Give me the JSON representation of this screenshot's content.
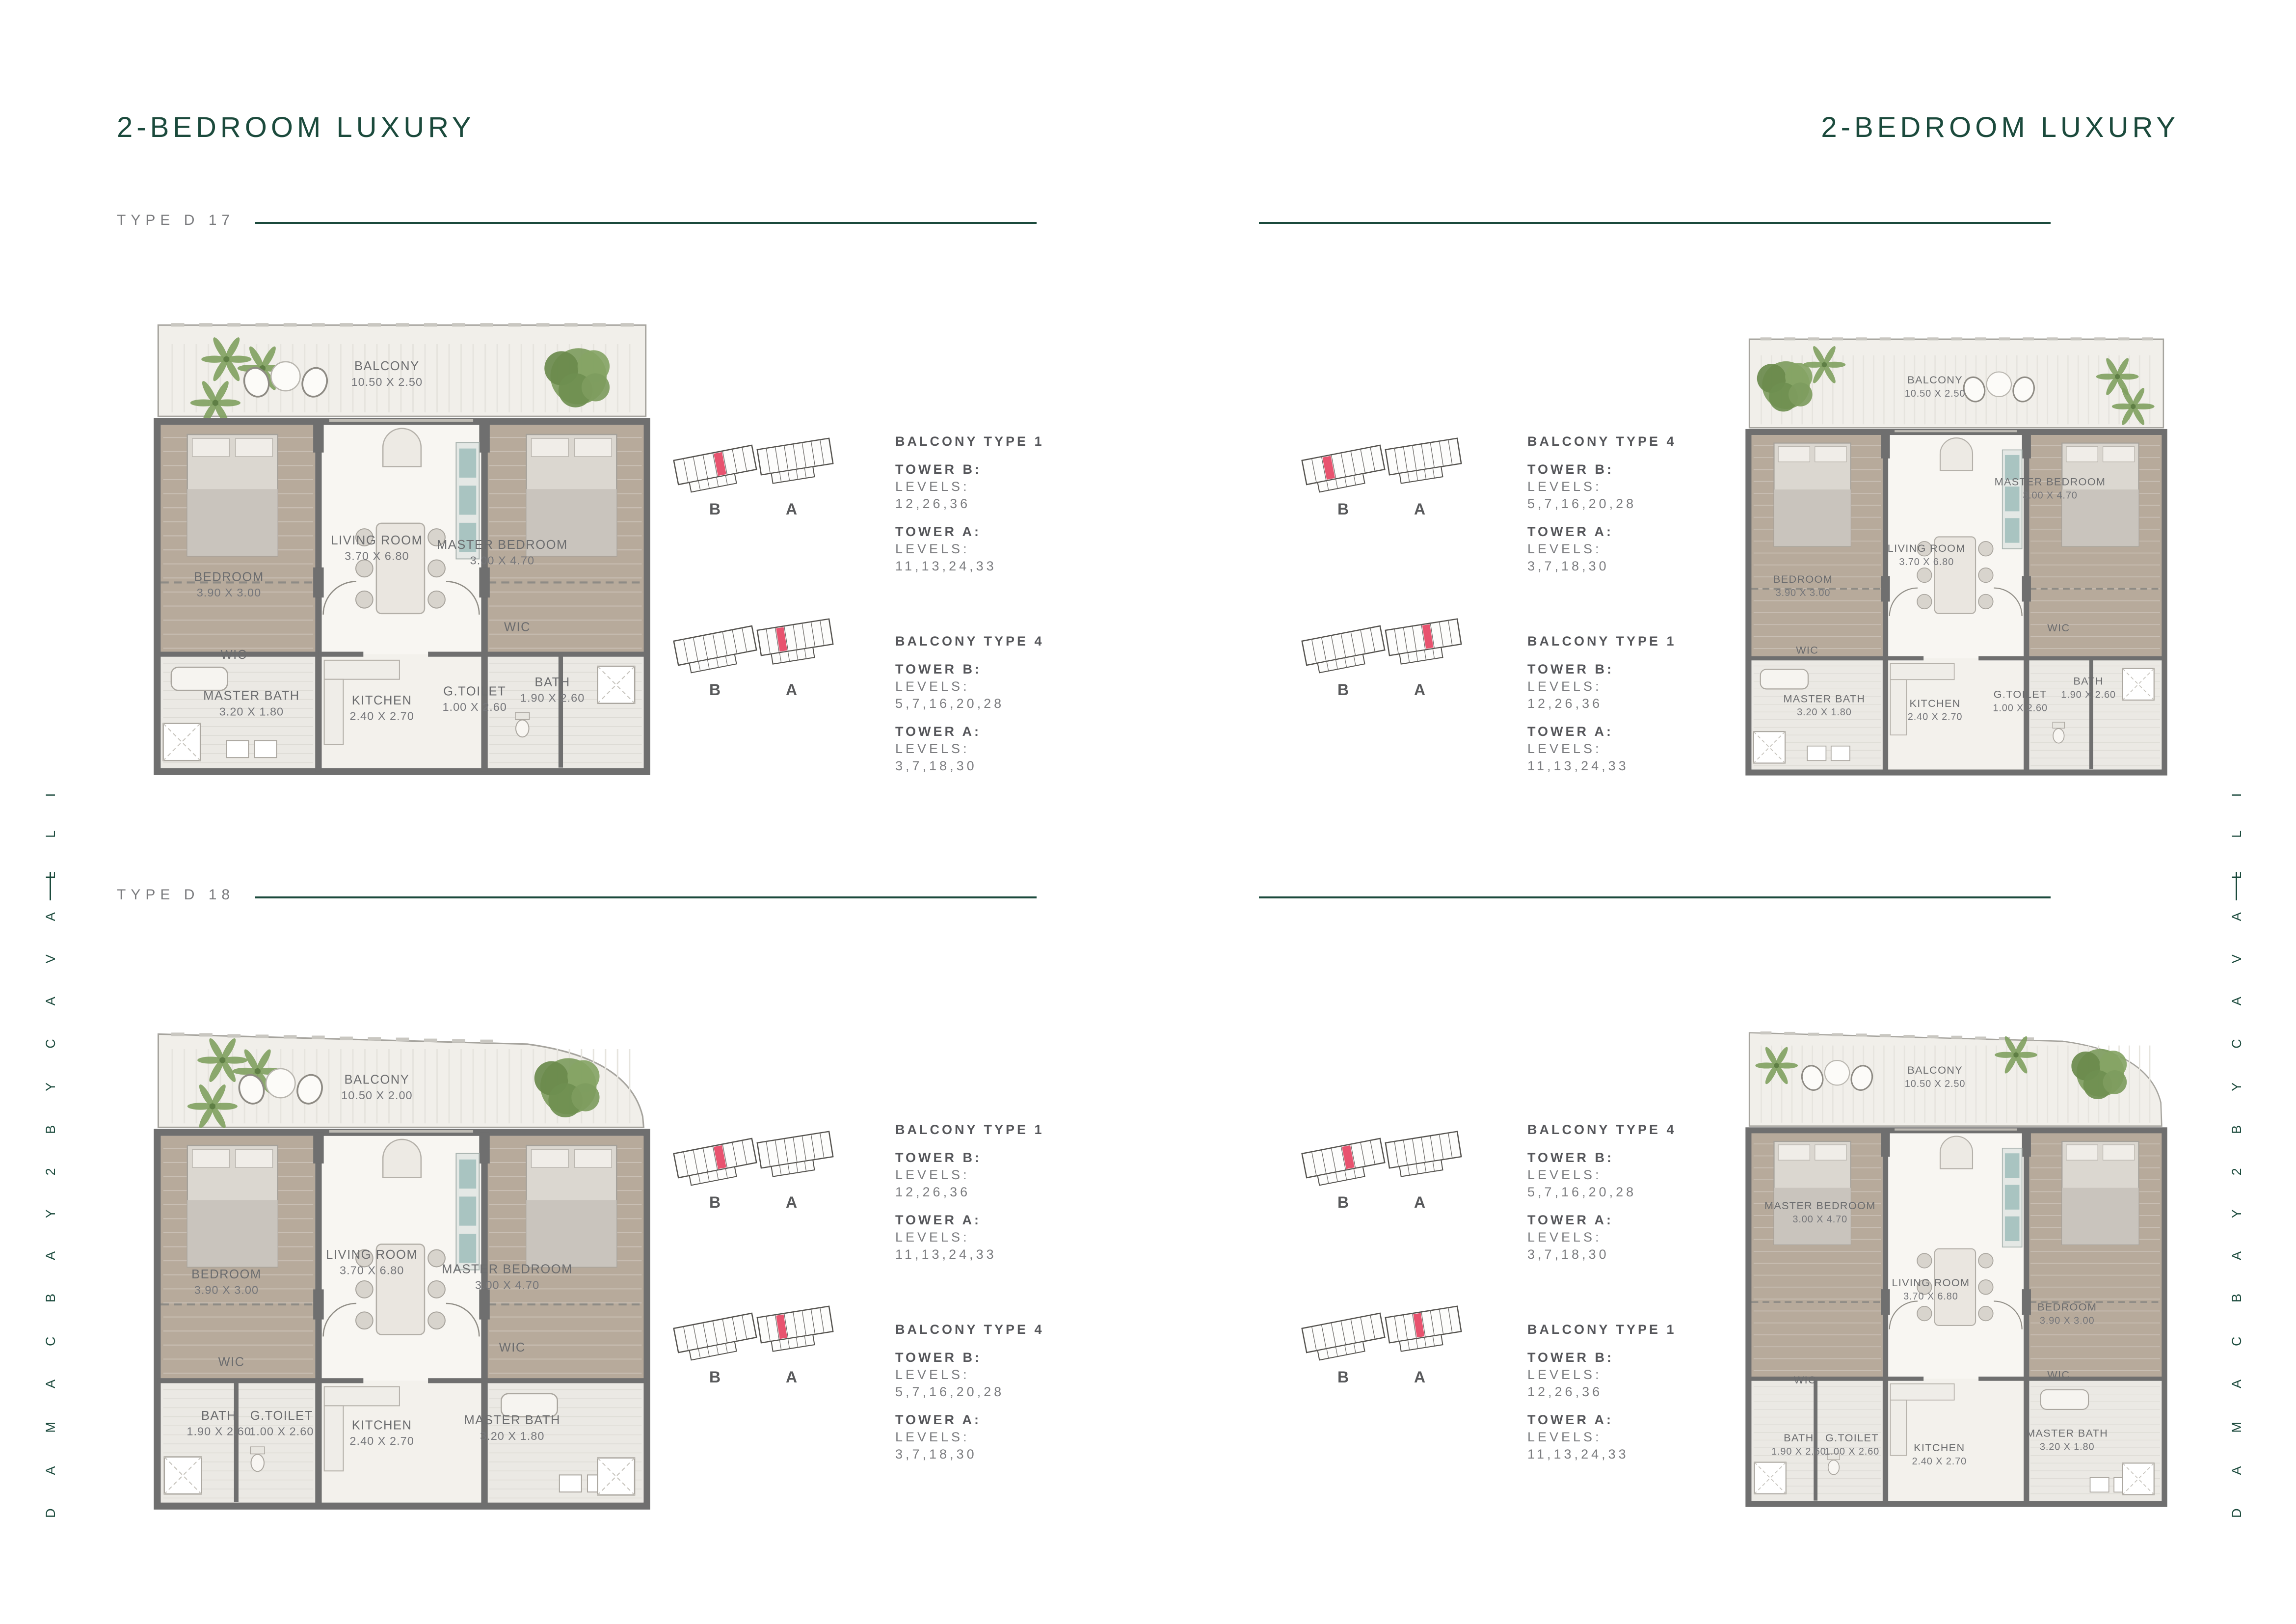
{
  "page": {
    "headers": {
      "left": "2-BEDROOM LUXURY",
      "right": "2-BEDROOM LUXURY"
    },
    "side_text": {
      "left": "D A M A C   B A Y 2   B Y   C A V A L L I",
      "right": "D A M A C   B A Y 2   B Y   C A V A L L I"
    },
    "colors": {
      "brand_green": "#1B4A3C",
      "type_gray": "#797A7D",
      "info_dark": "#55565A",
      "info_light": "#7B7C7F",
      "highlight_red": "#E8536F",
      "wall_gray": "#6F6F6F",
      "floor_tan": "#B7AA9B",
      "floor_tile": "#EBE9E4",
      "balcony": "#F1EFEA"
    }
  },
  "key_plan_labels": {
    "tower_b": "B",
    "tower_a": "A"
  },
  "quadrants": [
    {
      "id": "d17",
      "type_label": "TYPE D 17",
      "plan": {
        "balcony_curve": "none",
        "bath_split": "right",
        "rooms": [
          {
            "name": "BALCONY",
            "dims": "10.50 X 2.50",
            "x": 47,
            "y": 11
          },
          {
            "name": "BEDROOM",
            "dims": "3.90 X 3.00",
            "x": 15.5,
            "y": 57
          },
          {
            "name": "LIVING ROOM",
            "dims": "3.70 X 6.80",
            "x": 45,
            "y": 49
          },
          {
            "name": "MASTER BEDROOM",
            "dims": "3.00 X 4.70",
            "x": 70,
            "y": 50
          },
          {
            "name": "WIC",
            "dims": "",
            "x": 16.5,
            "y": 74
          },
          {
            "name": "WIC",
            "dims": "",
            "x": 73,
            "y": 68
          },
          {
            "name": "MASTER BATH",
            "dims": "3.20 X 1.80",
            "x": 20,
            "y": 83
          },
          {
            "name": "KITCHEN",
            "dims": "2.40 X 2.70",
            "x": 46,
            "y": 84
          },
          {
            "name": "G.TOILET",
            "dims": "1.00 X 2.60",
            "x": 64.5,
            "y": 82
          },
          {
            "name": "BATH",
            "dims": "1.90 X 2.60",
            "x": 80,
            "y": 80
          }
        ]
      },
      "key_plans": [
        {
          "highlight_tower": "B",
          "highlight_cell": 4
        },
        {
          "highlight_tower": "A",
          "highlight_cell": 2
        }
      ],
      "info_groups": [
        {
          "title": "BALCONY TYPE 1",
          "entries": [
            {
              "tower": "TOWER B:",
              "levels_label": "LEVELS:",
              "levels": "12,26,36"
            },
            {
              "tower": "TOWER A:",
              "levels_label": "LEVELS:",
              "levels": "11,13,24,33"
            }
          ]
        },
        {
          "title": "BALCONY TYPE 4",
          "entries": [
            {
              "tower": "TOWER B:",
              "levels_label": "LEVELS:",
              "levels": "5,7,16,20,28"
            },
            {
              "tower": "TOWER A:",
              "levels_label": "LEVELS:",
              "levels": "3,7,18,30"
            }
          ]
        }
      ]
    },
    {
      "id": "d19",
      "type_label": "TYPE D 19",
      "plan": {
        "balcony_curve": "none",
        "bath_split": "right",
        "rooms": [
          {
            "name": "BALCONY",
            "dims": "10.50 X 2.50",
            "x": 45,
            "y": 11
          },
          {
            "name": "BEDROOM",
            "dims": "3.90 X 3.00",
            "x": 14,
            "y": 56
          },
          {
            "name": "LIVING ROOM",
            "dims": "3.70 X 6.80",
            "x": 43,
            "y": 49
          },
          {
            "name": "MASTER BEDROOM",
            "dims": "3.00 X 4.70",
            "x": 72,
            "y": 34
          },
          {
            "name": "WIC",
            "dims": "",
            "x": 15,
            "y": 72
          },
          {
            "name": "WIC",
            "dims": "",
            "x": 74,
            "y": 67
          },
          {
            "name": "MASTER BATH",
            "dims": "3.20 X 1.80",
            "x": 19,
            "y": 83
          },
          {
            "name": "KITCHEN",
            "dims": "2.40 X 2.70",
            "x": 45,
            "y": 84
          },
          {
            "name": "G.TOILET",
            "dims": "1.00 X 2.60",
            "x": 65,
            "y": 82
          },
          {
            "name": "BATH",
            "dims": "1.90 X 2.60",
            "x": 81,
            "y": 79
          }
        ]
      },
      "key_plans": [
        {
          "highlight_tower": "B",
          "highlight_cell": 2
        },
        {
          "highlight_tower": "A",
          "highlight_cell": 4
        }
      ],
      "info_groups": [
        {
          "title": "BALCONY TYPE 4",
          "entries": [
            {
              "tower": "TOWER B:",
              "levels_label": "LEVELS:",
              "levels": "5,7,16,20,28"
            },
            {
              "tower": "TOWER A:",
              "levels_label": "LEVELS:",
              "levels": "3,7,18,30"
            }
          ]
        },
        {
          "title": "BALCONY TYPE 1",
          "entries": [
            {
              "tower": "TOWER B:",
              "levels_label": "LEVELS:",
              "levels": "12,26,36"
            },
            {
              "tower": "TOWER A:",
              "levels_label": "LEVELS:",
              "levels": "11,13,24,33"
            }
          ]
        }
      ]
    },
    {
      "id": "d18",
      "type_label": "TYPE D 18",
      "plan": {
        "balcony_curve": "right",
        "bath_split": "left",
        "rooms": [
          {
            "name": "BALCONY",
            "dims": "10.50 X 2.00",
            "x": 45,
            "y": 12
          },
          {
            "name": "BEDROOM",
            "dims": "3.90 X 3.00",
            "x": 15,
            "y": 52
          },
          {
            "name": "LIVING ROOM",
            "dims": "3.70 X 6.80",
            "x": 44,
            "y": 48
          },
          {
            "name": "MASTER BEDROOM",
            "dims": "3.00 X 4.70",
            "x": 71,
            "y": 51
          },
          {
            "name": "WIC",
            "dims": "",
            "x": 16,
            "y": 70
          },
          {
            "name": "WIC",
            "dims": "",
            "x": 72,
            "y": 67
          },
          {
            "name": "BATH",
            "dims": "1.90 X 2.60",
            "x": 13.5,
            "y": 81
          },
          {
            "name": "G.TOILET",
            "dims": "1.00 X 2.60",
            "x": 26,
            "y": 81
          },
          {
            "name": "KITCHEN",
            "dims": "2.40 X 2.70",
            "x": 46,
            "y": 83
          },
          {
            "name": "MASTER BATH",
            "dims": "3.20 X 1.80",
            "x": 72,
            "y": 82
          }
        ]
      },
      "key_plans": [
        {
          "highlight_tower": "B",
          "highlight_cell": 4
        },
        {
          "highlight_tower": "A",
          "highlight_cell": 2
        }
      ],
      "info_groups": [
        {
          "title": "BALCONY TYPE 1",
          "entries": [
            {
              "tower": "TOWER B:",
              "levels_label": "LEVELS:",
              "levels": "12,26,36"
            },
            {
              "tower": "TOWER A:",
              "levels_label": "LEVELS:",
              "levels": "11,13,24,33"
            }
          ]
        },
        {
          "title": "BALCONY TYPE 4",
          "entries": [
            {
              "tower": "TOWER B:",
              "levels_label": "LEVELS:",
              "levels": "5,7,16,20,28"
            },
            {
              "tower": "TOWER A:",
              "levels_label": "LEVELS:",
              "levels": "3,7,18,30"
            }
          ]
        }
      ]
    },
    {
      "id": "d20",
      "type_label": "TYPE D 20",
      "plan": {
        "balcony_curve": "right",
        "bath_split": "left",
        "rooms": [
          {
            "name": "BALCONY",
            "dims": "10.50 X 2.50",
            "x": 45,
            "y": 10
          },
          {
            "name": "MASTER BEDROOM",
            "dims": "3.00 X 4.70",
            "x": 18,
            "y": 38
          },
          {
            "name": "LIVING ROOM",
            "dims": "3.70 X 6.80",
            "x": 44,
            "y": 54
          },
          {
            "name": "BEDROOM",
            "dims": "3.90 X 3.00",
            "x": 76,
            "y": 59
          },
          {
            "name": "WIC",
            "dims": "",
            "x": 14.5,
            "y": 74
          },
          {
            "name": "WIC",
            "dims": "",
            "x": 74,
            "y": 73
          },
          {
            "name": "BATH",
            "dims": "1.90 X 2.60",
            "x": 13,
            "y": 86
          },
          {
            "name": "G.TOILET",
            "dims": "1.00 X 2.60",
            "x": 25.5,
            "y": 86
          },
          {
            "name": "KITCHEN",
            "dims": "2.40 X 2.70",
            "x": 46,
            "y": 88
          },
          {
            "name": "MASTER BATH",
            "dims": "3.20 X 1.80",
            "x": 76,
            "y": 85
          }
        ]
      },
      "key_plans": [
        {
          "highlight_tower": "B",
          "highlight_cell": 4
        },
        {
          "highlight_tower": "A",
          "highlight_cell": 3
        }
      ],
      "info_groups": [
        {
          "title": "BALCONY TYPE 4",
          "entries": [
            {
              "tower": "TOWER B:",
              "levels_label": "LEVELS:",
              "levels": "5,7,16,20,28"
            },
            {
              "tower": "TOWER A:",
              "levels_label": "LEVELS:",
              "levels": "3,7,18,30"
            }
          ]
        },
        {
          "title": "BALCONY TYPE 1",
          "entries": [
            {
              "tower": "TOWER B:",
              "levels_label": "LEVELS:",
              "levels": "12,26,36"
            },
            {
              "tower": "TOWER A:",
              "levels_label": "LEVELS:",
              "levels": "11,13,24,33"
            }
          ]
        }
      ]
    }
  ]
}
